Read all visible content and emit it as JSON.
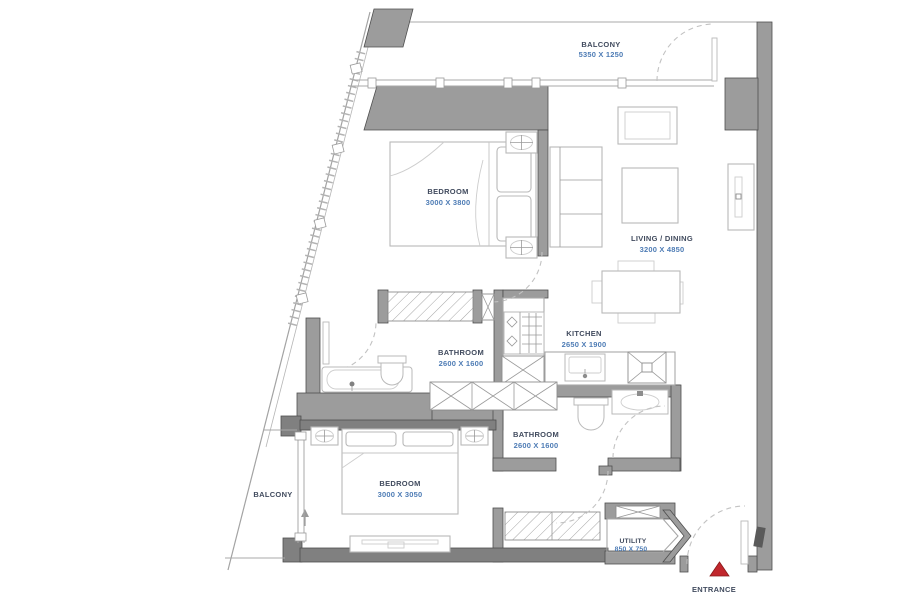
{
  "rooms": {
    "balcony_top": {
      "name": "BALCONY",
      "dims": "5350 X 1250"
    },
    "bedroom_1": {
      "name": "BEDROOM",
      "dims": "3000 X 3800"
    },
    "living_dining": {
      "name": "LIVING / DINING",
      "dims": "3200 X 4850"
    },
    "kitchen": {
      "name": "KITCHEN",
      "dims": "2650 X 1900"
    },
    "bathroom_1": {
      "name": "BATHROOM",
      "dims": "2600 X 1600"
    },
    "bathroom_2": {
      "name": "BATHROOM",
      "dims": "2600 X 1600"
    },
    "bedroom_2": {
      "name": "BEDROOM",
      "dims": "3000 X 3050"
    },
    "balcony_side": {
      "name": "BALCONY"
    },
    "utility": {
      "name": "UTILITY",
      "dims": "850 X 750"
    },
    "entrance": {
      "name": "ENTRANCE"
    }
  },
  "colors": {
    "wall": "#9c9c9c",
    "wall_edge": "#4f4f4f",
    "wall_dark": "#808080",
    "furn": "#b9b9b9",
    "furn_light": "#cdcdcd",
    "door": "#c2c2c2",
    "label": "#414b5e",
    "dims": "#4e7cb5",
    "marker": "#c1272d"
  }
}
